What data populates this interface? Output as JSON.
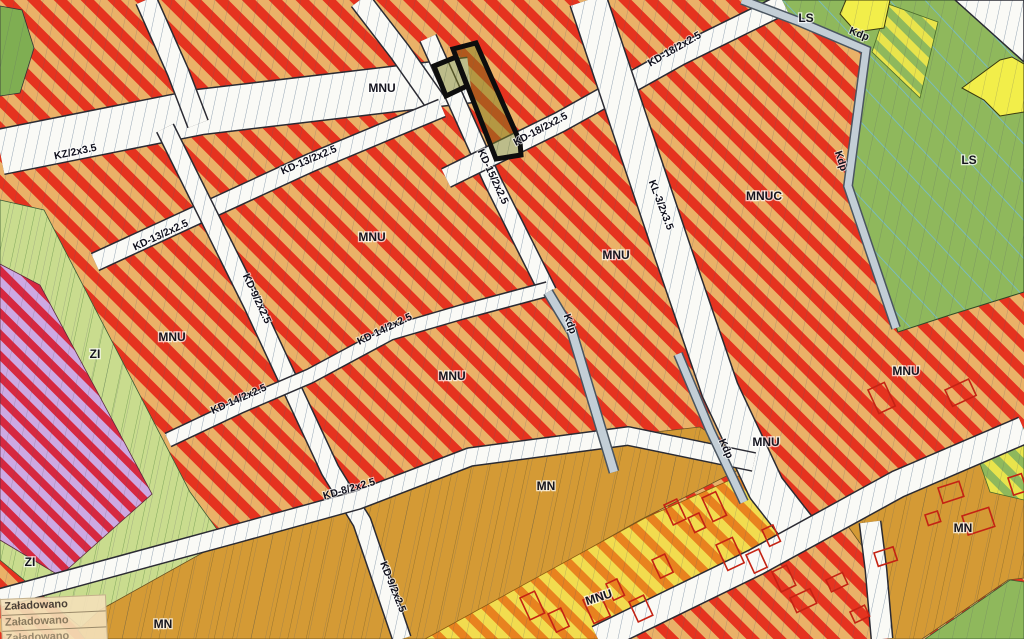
{
  "map": {
    "title": "zoning-plan-map",
    "labels": {
      "zones": [
        {
          "t": "MNU",
          "x": 382,
          "y": 92,
          "r": 0
        },
        {
          "t": "MNU",
          "x": 372,
          "y": 241,
          "r": 0
        },
        {
          "t": "MNU",
          "x": 172,
          "y": 341,
          "r": 0
        },
        {
          "t": "MNU",
          "x": 452,
          "y": 380,
          "r": 0
        },
        {
          "t": "MNU",
          "x": 616,
          "y": 259,
          "r": 0
        },
        {
          "t": "MNUC",
          "x": 764,
          "y": 200,
          "r": 0
        },
        {
          "t": "MNU",
          "x": 766,
          "y": 446,
          "r": 0
        },
        {
          "t": "MNU",
          "x": 906,
          "y": 375,
          "r": 0
        },
        {
          "t": "MNU",
          "x": 600,
          "y": 601,
          "r": -18
        },
        {
          "t": "MN",
          "x": 546,
          "y": 490,
          "r": 0
        },
        {
          "t": "MN",
          "x": 163,
          "y": 628,
          "r": 0
        },
        {
          "t": "MN",
          "x": 963,
          "y": 532,
          "r": 0
        },
        {
          "t": "LS",
          "x": 806,
          "y": 22,
          "r": 0
        },
        {
          "t": "LS",
          "x": 969,
          "y": 164,
          "r": 0
        },
        {
          "t": "ZI",
          "x": 95,
          "y": 358,
          "r": 0
        },
        {
          "t": "ZI",
          "x": 30,
          "y": 566,
          "r": 0
        }
      ],
      "roads": [
        {
          "t": "KZ/2x3.5",
          "x": 76,
          "y": 155,
          "r": -12
        },
        {
          "t": "KD-13/2x2.5",
          "x": 310,
          "y": 163,
          "r": -23
        },
        {
          "t": "KD-13/2x2.5",
          "x": 162,
          "y": 238,
          "r": -25
        },
        {
          "t": "KD-9/2x2.5",
          "x": 254,
          "y": 300,
          "r": 65
        },
        {
          "t": "KD-9/2x2.5",
          "x": 390,
          "y": 588,
          "r": 68
        },
        {
          "t": "KD-15/2x2.5",
          "x": 490,
          "y": 178,
          "r": 65
        },
        {
          "t": "KD-18/2x2.5",
          "x": 542,
          "y": 132,
          "r": -28
        },
        {
          "t": "KD-18/2x2.5",
          "x": 676,
          "y": 52,
          "r": -30
        },
        {
          "t": "KL-3/2x3.5",
          "x": 658,
          "y": 206,
          "r": 69
        },
        {
          "t": "KD-14/2x2.5",
          "x": 386,
          "y": 332,
          "r": -26
        },
        {
          "t": "KD-14/2x2.5",
          "x": 240,
          "y": 402,
          "r": -24
        },
        {
          "t": "KD-8/2x2.5",
          "x": 350,
          "y": 492,
          "r": -16
        },
        {
          "t": "Kdp",
          "x": 858,
          "y": 37,
          "r": 22
        },
        {
          "t": "Kdp",
          "x": 838,
          "y": 162,
          "r": 72
        },
        {
          "t": "Kdp",
          "x": 567,
          "y": 325,
          "r": 70
        },
        {
          "t": "Kdp",
          "x": 723,
          "y": 450,
          "r": 65
        }
      ]
    },
    "status_panel": {
      "rows": [
        "Załadowano",
        "Załadowano",
        "Załadowano"
      ]
    },
    "colors": {
      "mnu_base": "#EAB168",
      "mnu_stripe": "#E5331F",
      "mn_fill": "#D49A35",
      "mnu_yellow_base": "#F2DC4F",
      "mnu_yellow_stripe": "#E8821F",
      "zi_fill": "#C9DC8E",
      "violet_base": "#CDA9E2",
      "violet_stripe": "#D62840",
      "ls_fill": "#8FB85C",
      "star_yellow": "#F2EE4A",
      "road_fill": "#FAFAF6",
      "kdp_fill": "#C3CED6",
      "building_outline": "#C42314",
      "selected_outline": "#0D0D0D"
    }
  }
}
